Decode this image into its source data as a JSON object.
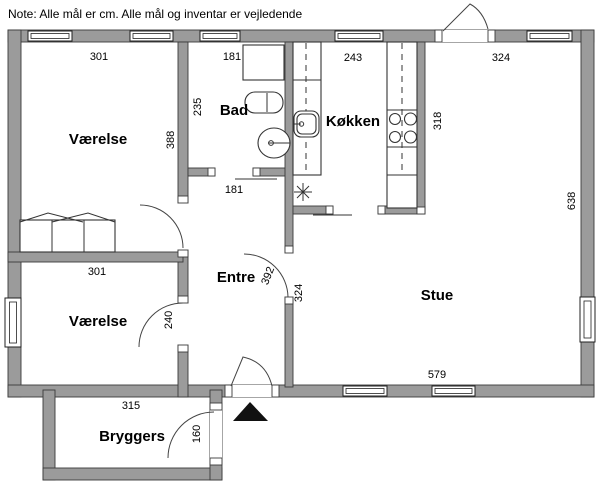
{
  "note": "Note: Alle mål er cm. Alle mål og inventar er vejledende",
  "colors": {
    "wall_fill": "#9b9b9b",
    "wall_outline": "#3a3a3a",
    "arrow": "#111111"
  },
  "rooms": {
    "vaerelse1": {
      "label": "Værelse",
      "width_cm": "301",
      "depth_cm": "388"
    },
    "bad": {
      "label": "Bad",
      "width_cm": "181",
      "depth_cm": "235",
      "door_width_cm": "181"
    },
    "koekken": {
      "label": "Køkken",
      "width_cm": "243",
      "depth_cm": "318"
    },
    "stue": {
      "label": "Stue",
      "width_cm": "324",
      "depth_cm": "638",
      "bottom_width_cm": "579",
      "left_depth_cm": "324"
    },
    "entre": {
      "label": "Entre",
      "depth_cm": "392"
    },
    "vaerelse2": {
      "label": "Værelse",
      "width_cm": "301",
      "depth_cm": "240"
    },
    "bryggers": {
      "label": "Bryggers",
      "width_cm": "315",
      "door_cm": "160"
    }
  }
}
